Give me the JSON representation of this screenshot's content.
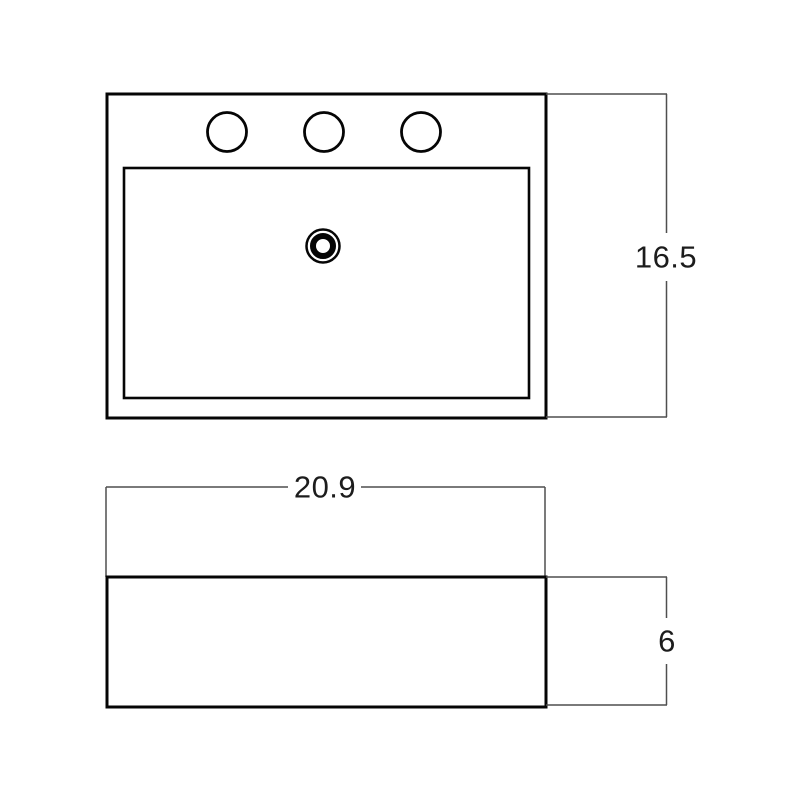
{
  "drawing": {
    "subject": "vessel-sink-technical-drawing",
    "views": {
      "top": {
        "name": "top view",
        "faucet_hole_count": 3
      },
      "front": {
        "name": "front view"
      }
    },
    "dimensions": {
      "height": {
        "label": "16.5"
      },
      "width": {
        "label": "20.9"
      },
      "depth": {
        "label": "6"
      }
    },
    "colors": {
      "background": "#ffffff",
      "outline": "#050505",
      "dimension_line": "#4f4f4f",
      "text": "#1c1c1c"
    }
  }
}
